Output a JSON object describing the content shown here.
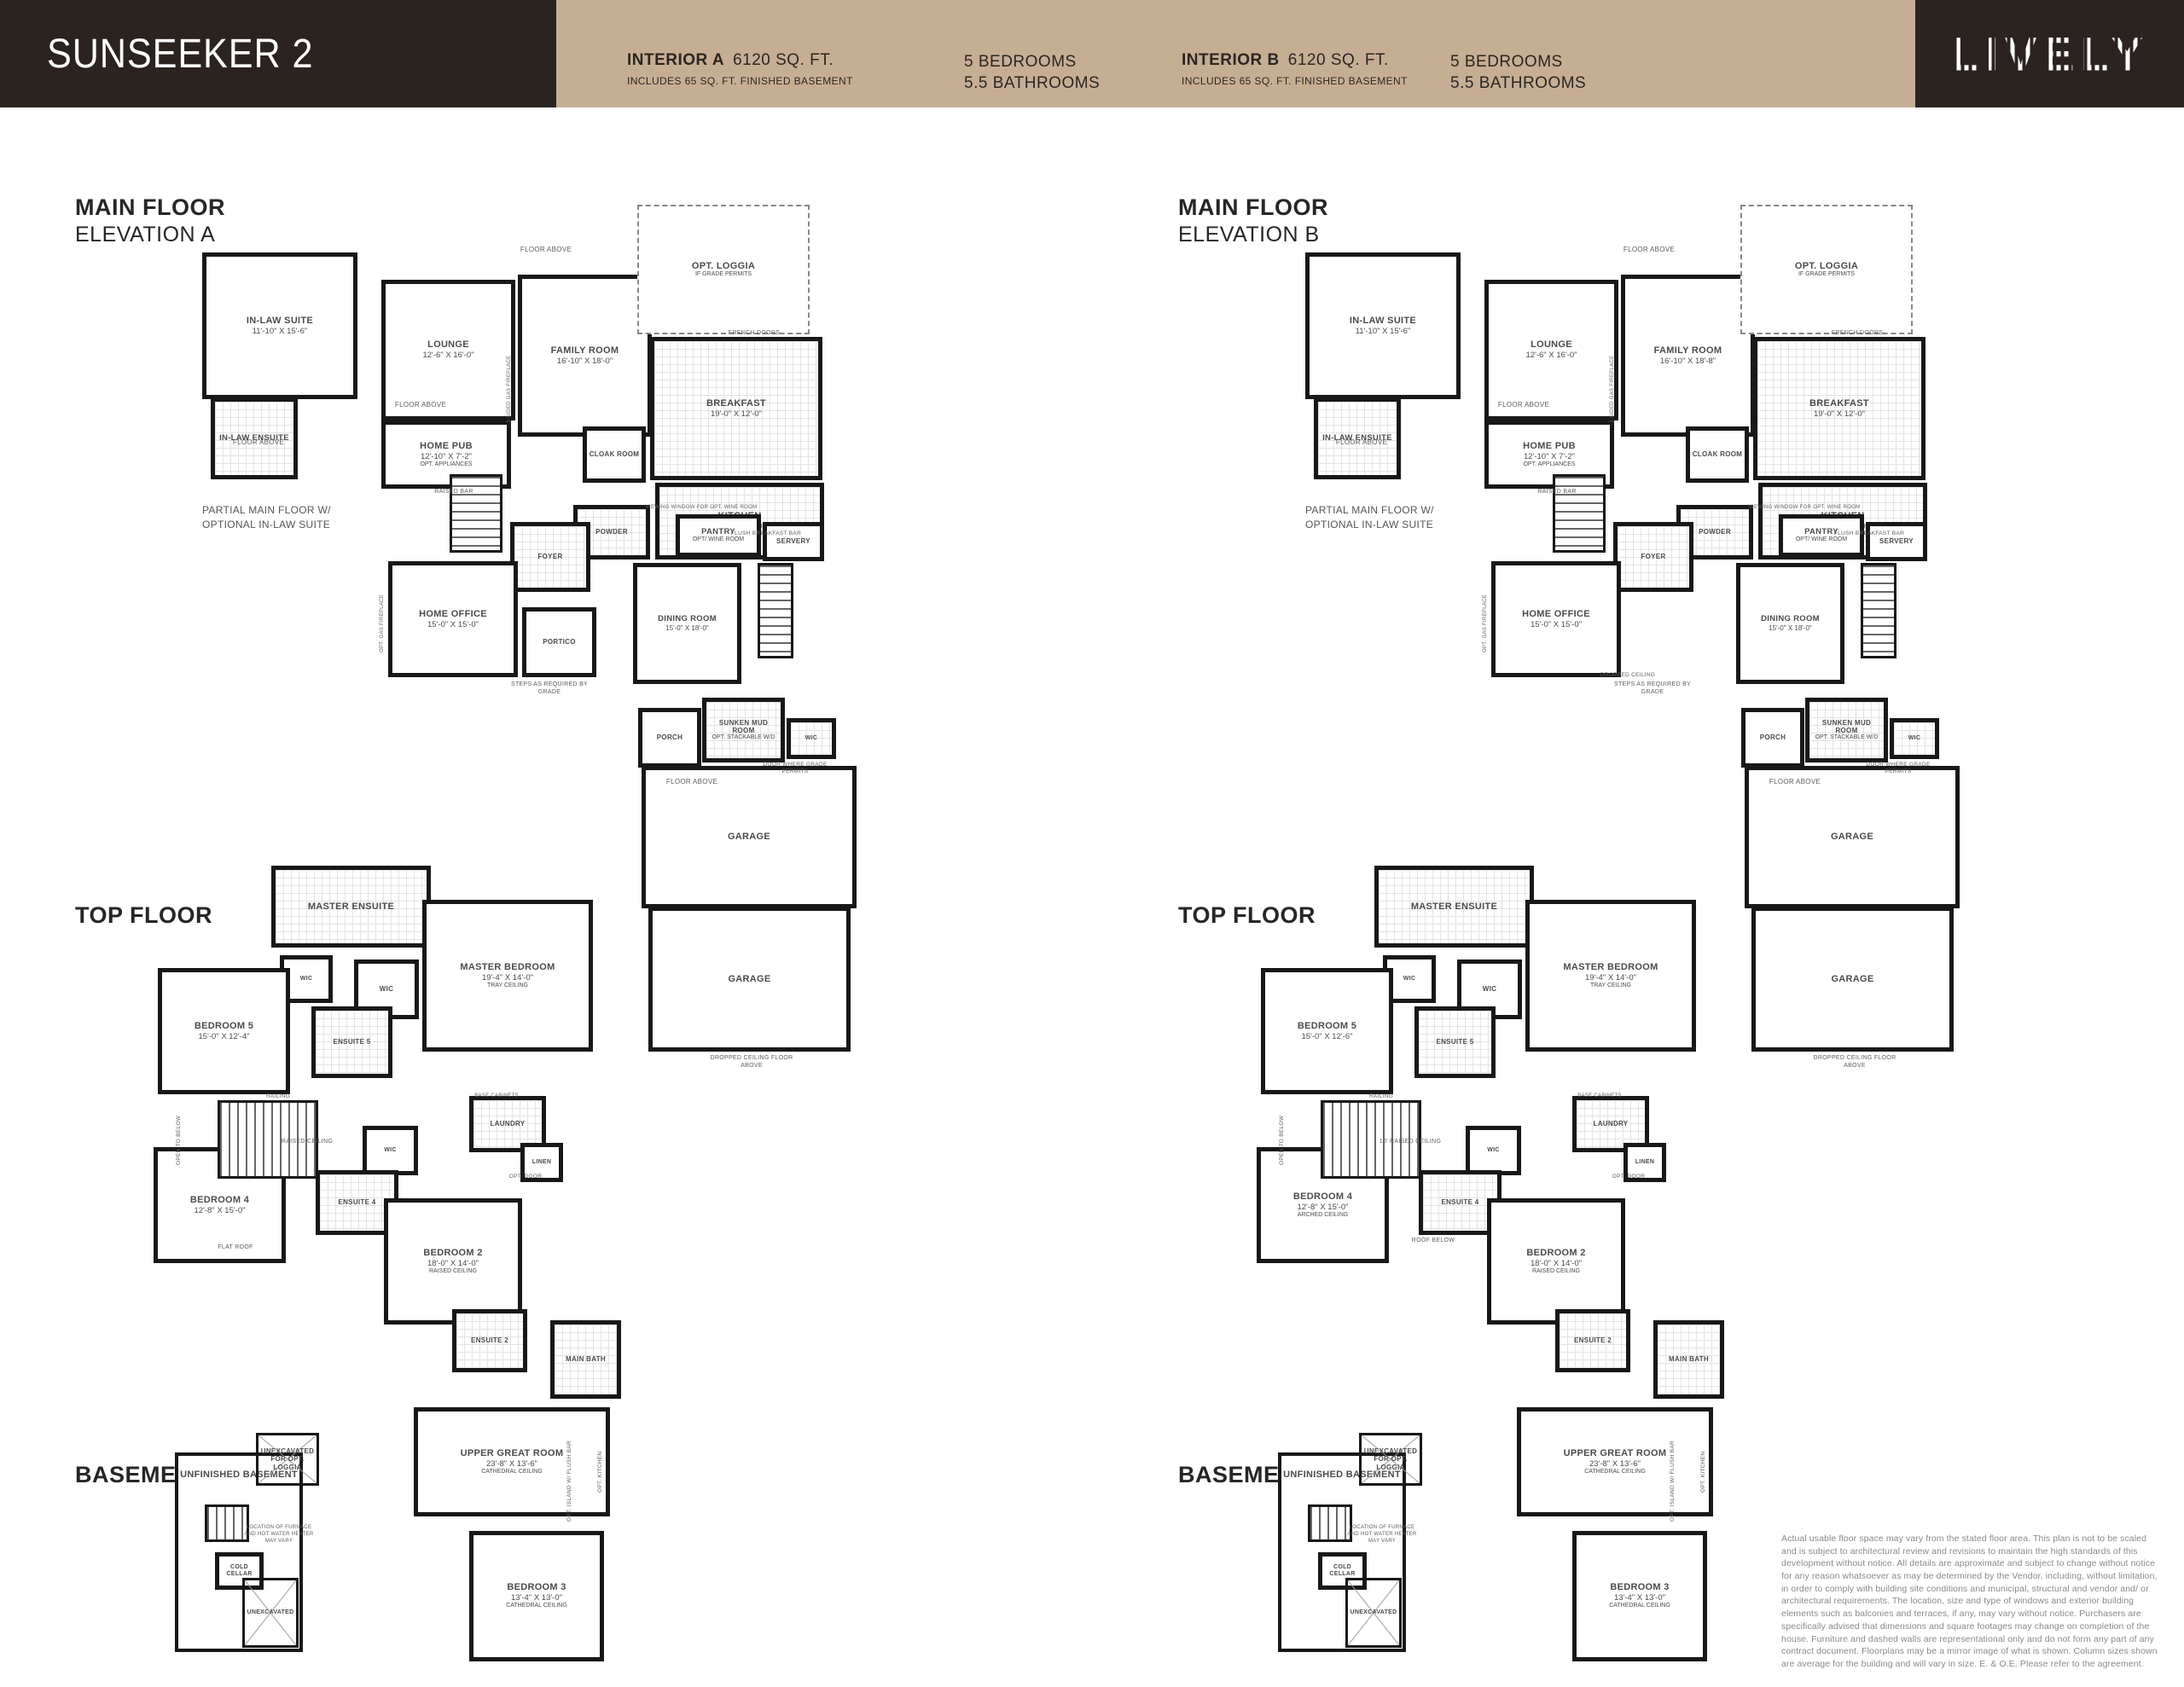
{
  "header": {
    "model": "SUNSEEKER 2",
    "logo": "LIVELY",
    "interiors": [
      {
        "name": "INTERIOR A",
        "sqft": "6120 SQ. FT.",
        "includes": "INCLUDES 65 SQ. FT. FINISHED BASEMENT",
        "beds": "5 BEDROOMS",
        "baths": "5.5 BATHROOMS"
      },
      {
        "name": "INTERIOR B",
        "sqft": "6120 SQ. FT.",
        "includes": "INCLUDES 65 SQ. FT. FINISHED BASEMENT",
        "beds": "5 BEDROOMS",
        "baths": "5.5 BATHROOMS"
      }
    ]
  },
  "sections": {
    "main_a_title": "MAIN FLOOR",
    "main_a_sub": "ELEVATION A",
    "main_b_title": "MAIN FLOOR",
    "main_b_sub": "ELEVATION B",
    "top_title": "TOP FLOOR",
    "basement_title": "BASEMENT",
    "partial_caption": "PARTIAL MAIN FLOOR W/ OPTIONAL IN-LAW SUITE"
  },
  "rooms": {
    "in_law_suite": {
      "name": "IN-LAW SUITE",
      "dims": "11'-10\" X 15'-6\""
    },
    "in_law_ensuite": {
      "name": "IN-LAW ENSUITE"
    },
    "lounge": {
      "name": "LOUNGE",
      "dims": "12'-6\" X 16'-0\""
    },
    "family_a": {
      "name": "FAMILY ROOM",
      "dims": "16'-10\" X 18'-0\""
    },
    "family_b": {
      "name": "FAMILY ROOM",
      "dims": "16'-10\" X 18'-8\""
    },
    "loggia": {
      "name": "OPT. LOGGIA",
      "note": "IF GRADE PERMITS"
    },
    "breakfast": {
      "name": "BREAKFAST",
      "dims": "19'-0\" X 12'-0\""
    },
    "home_pub": {
      "name": "HOME PUB",
      "dims": "12'-10\" X 7'-2\"",
      "note": "OPT. APPLIANCES"
    },
    "cloak": {
      "name": "CLOAK ROOM"
    },
    "kitchen": {
      "name": "KITCHEN",
      "dims": "19'-0\" X 13'-0\""
    },
    "powder": {
      "name": "POWDER"
    },
    "pantry": {
      "name": "PANTRY",
      "note": "OPT/ WINE ROOM"
    },
    "servery": {
      "name": "SERVERY"
    },
    "foyer": {
      "name": "FOYER"
    },
    "home_office": {
      "name": "HOME OFFICE",
      "dims": "15'-0\" X 15'-0\""
    },
    "portico": {
      "name": "PORTICO"
    },
    "dining": {
      "name": "DINING ROOM",
      "dims": "15'-0\" X 18'-0\""
    },
    "porch": {
      "name": "PORCH"
    },
    "mud": {
      "name": "SUNKEN MUD ROOM",
      "note": "OPT. STACKABLE W/D"
    },
    "wic": {
      "name": "WIC"
    },
    "garage": {
      "name": "GARAGE"
    },
    "master_ensuite": {
      "name": "MASTER ENSUITE"
    },
    "master_bedroom": {
      "name": "MASTER BEDROOM",
      "dims": "19'-4\" X 14'-0\"",
      "note": "TRAY CEILING"
    },
    "bedroom5_a": {
      "name": "BEDROOM 5",
      "dims": "15'-0\" X 12'-4\""
    },
    "bedroom5_b": {
      "name": "BEDROOM 5",
      "dims": "15'-0\" X 12'-6\""
    },
    "ensuite5": {
      "name": "ENSUITE 5"
    },
    "bedroom4_a": {
      "name": "BEDROOM 4",
      "dims": "12'-8\" X 15'-0\""
    },
    "bedroom4_b": {
      "name": "BEDROOM 4",
      "dims": "12'-8\" X 15'-0\"",
      "note": "ARCHED CEILING"
    },
    "ensuite4": {
      "name": "ENSUITE 4"
    },
    "bedroom2": {
      "name": "BEDROOM 2",
      "dims": "18'-0\" X 14'-0\"",
      "note": "RAISED CEILING"
    },
    "ensuite2": {
      "name": "ENSUITE 2"
    },
    "main_bath": {
      "name": "MAIN BATH"
    },
    "laundry": {
      "name": "LAUNDRY"
    },
    "linen": {
      "name": "LINEN"
    },
    "upper_great": {
      "name": "UPPER GREAT ROOM",
      "dims": "23'-8\" X 13'-6\"",
      "note": "CATHEDRAL CEILING"
    },
    "bedroom3": {
      "name": "BEDROOM 3",
      "dims": "13'-4\" X 13'-0\"",
      "note": "CATHEDRAL CEILING"
    },
    "unfinished_basement": {
      "name": "UNFINISHED BASEMENT"
    },
    "cold_cellar": {
      "name": "COLD CELLAR"
    },
    "unexcavated_loggia": {
      "name": "UNEXCAVATED FOR OPT. LOGGIA"
    },
    "unexcavated": {
      "name": "UNEXCAVATED"
    }
  },
  "annotations": {
    "floor_above": "FLOOR ABOVE",
    "raised_bar": "RAISED BAR",
    "flush_bar": "FLUSH BREAKFAST BAR",
    "french_doors": "FRENCH DOORS",
    "steps": "STEPS AS REQUIRED BY GRADE",
    "dropped_floor": "DROPPED CEILING FLOOR ABOVE",
    "dropped_ceiling": "DROPPED CEILING",
    "door_grade": "DOOR WHERE GRADE PERMITS",
    "viewing": "VIEWING WINDOW FOR OPT. WINE ROOM",
    "fireplace3": "3-SIDED GAS FIREPLACE",
    "opt_fireplace": "OPT. GAS FIREPLACE",
    "open_below": "OPEN TO BELOW",
    "railing": "RAILING",
    "raised_ceiling": "RAISED CEILING",
    "raised_ceiling_b": "10' RAISED CEILING",
    "base_cabinets": "BASE CABINETS",
    "opt_door": "OPT. DOOR",
    "flat_roof": "FLAT ROOF",
    "roof_below": "ROOF BELOW",
    "opt_island": "OPT. ISLAND W/ FLUSH BAR",
    "opt_kitchen": "OPT. KITCHEN",
    "furnace": "LOCATION OF FURNACE AND HOT WATER HEATER MAY VARY"
  },
  "disclaimer": "Actual usable floor space may vary from the stated floor area. This plan is not to be scaled and is subject to architectural review and revisions to maintain the high standards of this development without notice. All details are approximate and subject to change without notice for any reason whatsoever as may be determined by the Vendor, including, without limitation, in order to comply with building site conditions and municipal, structural and vendor and/ or architectural requirements. The location, size and type of windows and exterior building elements such as balconies and terraces, if any, may vary without notice. Purchasers are specifically advised that dimensions and square footages may change on completion of the house. Furniture and dashed walls are representational only and do not form any part of any contract document. Floorplans may be a mirror image of what is shown. Column sizes shown are average for the building and will vary in size. E. & O.E. Please refer to the agreement."
}
